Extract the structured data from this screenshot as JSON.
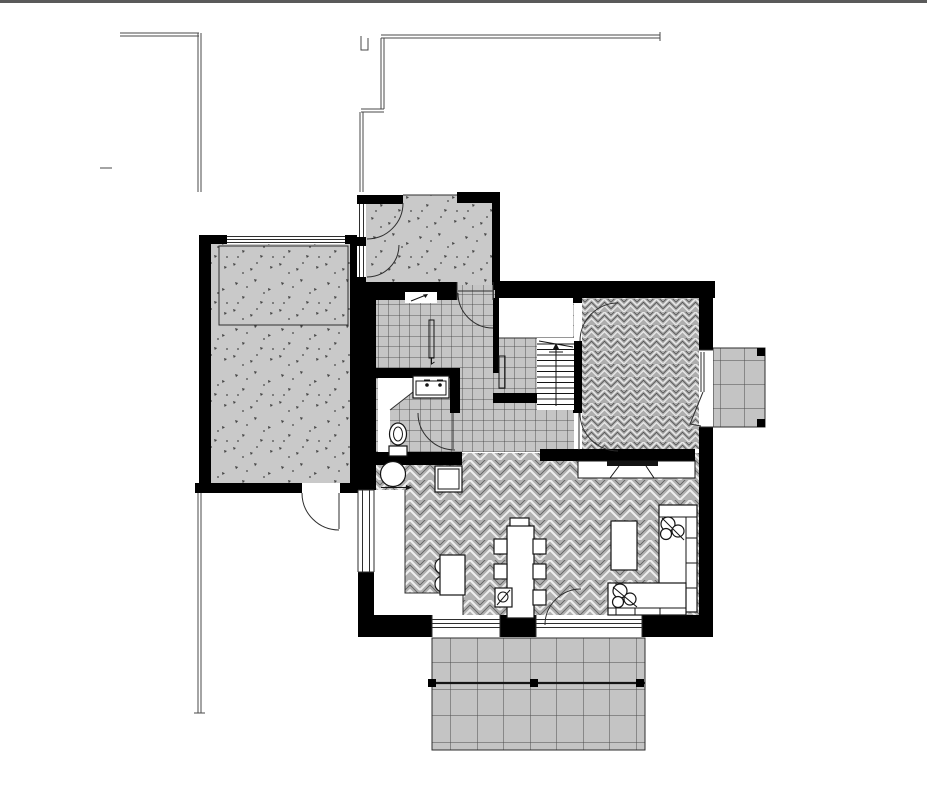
{
  "meta": {
    "type": "architectural-floor-plan",
    "view": "top-down ground floor plan, monochrome CAD drawing",
    "visible_text": "none"
  },
  "colors": {
    "wall": "#000000",
    "line": "#2e2e2e",
    "boundary": "#4a4a4a",
    "top_border": "#5a5a5a",
    "white": "#ffffff",
    "stipple_bg": "#c9c9c9",
    "stipple_mark": "#474747",
    "tile_bg": "#c5c5c5",
    "tile_line": "#383838",
    "hb_bg": "#b1b1b1",
    "hb_light": "#efefef",
    "hb_dark": "#636363",
    "hbd_bg": "#adadad",
    "hbd_light": "#e8e8e8",
    "hbd_dark": "#4f4f4f",
    "paving_bg": "#c4c4c4",
    "paving_line": "#4d4d4d",
    "fixture_stroke": "#141414"
  },
  "site": {
    "boundaries": [
      "top-border-line",
      "left-fence-double-line",
      "left-fence-lower-double-line",
      "right-stepped-boundary-line"
    ]
  },
  "rooms": [
    {
      "id": "garage",
      "finish": "stippled-paving",
      "features": [
        "parking-bay-outline",
        "garage-door-top",
        "side-door-bottom"
      ]
    },
    {
      "id": "entry-porch",
      "finish": "stippled-paving",
      "features": [
        "two-swing-doors-left",
        "front-door-to-hall",
        "entry-niche-arrow"
      ]
    },
    {
      "id": "hall",
      "finish": "square-tile",
      "features": [
        "radiator",
        "front-door-swing"
      ]
    },
    {
      "id": "wc",
      "finish": "square-tile",
      "features": [
        "toilet",
        "vanity-two-taps",
        "diagonal-screen",
        "door-swing"
      ]
    },
    {
      "id": "stair-hall",
      "finish": "white",
      "features": [
        "staircase-with-arrow",
        "tiled-closet",
        "radiator"
      ]
    },
    {
      "id": "study-room",
      "finish": "dense-herringbone",
      "features": [
        "door-swing-upper",
        "door-swing-lower",
        "balcony-door"
      ]
    },
    {
      "id": "living-dining",
      "finish": "herringbone",
      "features": [
        "dining-table",
        "six-chairs",
        "corner-sofa",
        "coffee-table",
        "tv-sideboard",
        "terrace-door-swing"
      ]
    },
    {
      "id": "kitchen",
      "finish": "white-counter-zone",
      "features": [
        "l-counter",
        "island-with-stools",
        "round-table",
        "floor-hatch"
      ]
    },
    {
      "id": "terrace",
      "finish": "square-paving-grid",
      "features": [
        "pergola-beam",
        "three-posts"
      ]
    },
    {
      "id": "balcony",
      "finish": "square-paving-grid",
      "features": [
        "two-corner-posts"
      ]
    }
  ],
  "furniture": [
    "dining-table",
    "head-chair",
    "chair",
    "high-chair",
    "corner-sofa",
    "pillows",
    "coffee-table",
    "tv",
    "sideboard",
    "kitchen-island",
    "bar-stools",
    "round-table",
    "toilet",
    "vanity",
    "radiator",
    "staircase"
  ]
}
